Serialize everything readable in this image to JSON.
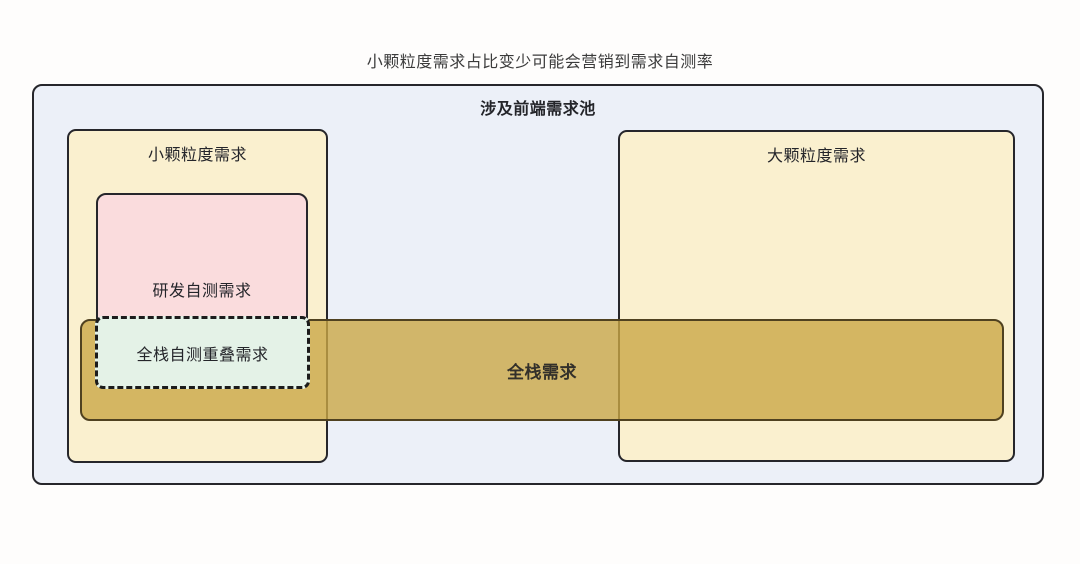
{
  "page": {
    "title": "小颗粒度需求占比变少可能会营销到需求自测率"
  },
  "diagram": {
    "pool": {
      "label": "涉及前端需求池"
    },
    "small": {
      "label": "小颗粒度需求"
    },
    "rd": {
      "label": "研发自测需求"
    },
    "overlap": {
      "label": "全栈自测重叠需求"
    },
    "band": {
      "label": "全栈需求"
    },
    "large": {
      "label": "大颗粒度需求"
    }
  },
  "colors": {
    "page_bg": "#fefdfc",
    "title_color": "#3b3b3b",
    "text_color": "#24252a",
    "pool_bg": "#ecf0f8",
    "box_border": "#26262b",
    "granularity_bg": "#faf0cf",
    "rd_bg": "#fadcdd",
    "overlap_bg": "#e4f2e7",
    "overlap_border": "#1c1c1c",
    "band_bg": "rgba(202,167,70,0.8)",
    "band_border": "#4f4120",
    "band_text": "#33302a"
  }
}
